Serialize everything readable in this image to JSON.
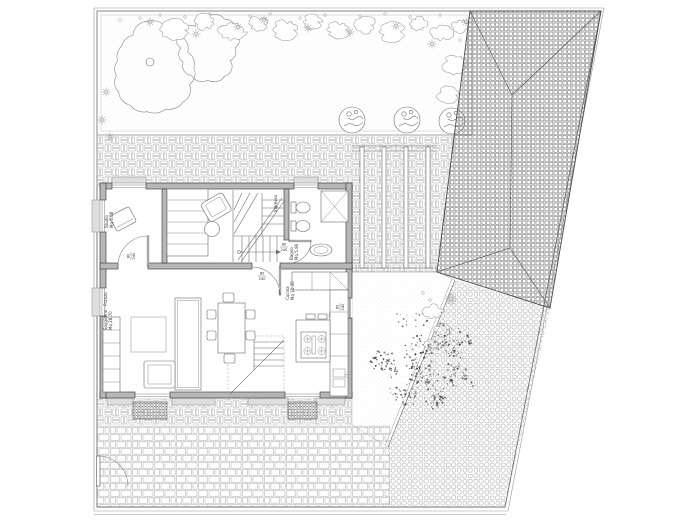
{
  "drawing": {
    "kind": "architectural floor / site plan",
    "colors": {
      "paper": "#ffffff",
      "line": "#444444",
      "wall_fill": "#b7b7b7",
      "sill_fill": "#dedede",
      "pattern_light": "#b0b0b0",
      "roof_hatch": "#6d6d6d"
    },
    "rooms": [
      {
        "id": "studio",
        "label": "Studio",
        "area": "Mq 5.08",
        "x": 108,
        "y": 228,
        "rot": -90
      },
      {
        "id": "ingresso",
        "label": "Ingresso",
        "area": "",
        "x": 277,
        "y": 212,
        "rot": -90
      },
      {
        "id": "bagno",
        "label": "Bagno",
        "area": "Mq 5.96",
        "x": 293,
        "y": 260,
        "rot": -90
      },
      {
        "id": "cucina",
        "label": "Cucina",
        "area": "Mq 11.35",
        "x": 289,
        "y": 300,
        "rot": -90
      },
      {
        "id": "soggiorno",
        "label": "Soggiorno - Pranzo",
        "area": "Mq 28.70",
        "x": 107,
        "y": 330,
        "rot": -90
      }
    ],
    "door_tags": [
      {
        "w": "80",
        "h": "240",
        "x": 131,
        "y": 256,
        "rot": -90
      },
      {
        "w": "80",
        "h": "240",
        "x": 284,
        "y": 247,
        "rot": 0
      },
      {
        "w": "80",
        "h": "240",
        "x": 262,
        "y": 276,
        "rot": 0
      },
      {
        "w": "80",
        "h": "240",
        "x": 340,
        "y": 307,
        "rot": -90
      }
    ]
  }
}
